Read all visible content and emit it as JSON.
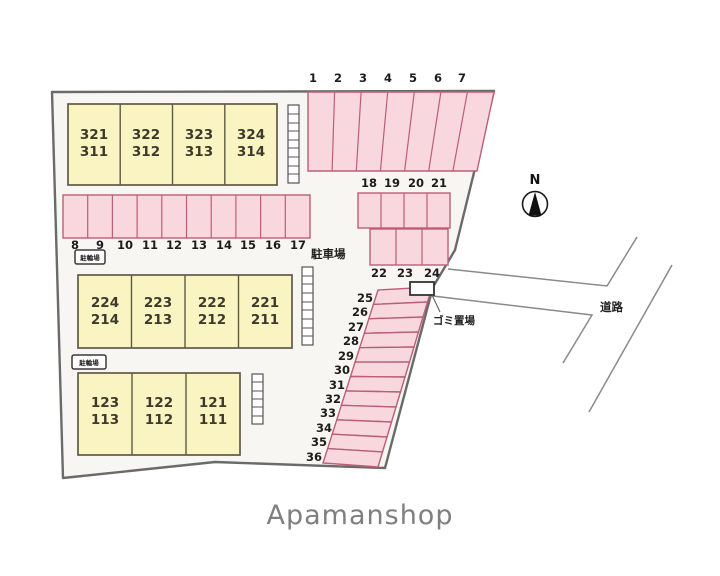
{
  "page": {
    "caption": "Apamanshop"
  },
  "compass": {
    "label": "N"
  },
  "labels": {
    "parking_lot": "駐車場",
    "garbage_area": "ゴミ置場",
    "road": "道路",
    "bicycle_area": "駐輪場"
  },
  "colors": {
    "stall_fill": "#f8d7de",
    "stall_border": "#bb5f78",
    "building_fill": "#faf4c3",
    "building_border": "#5f5a45",
    "site_boundary": "#6a6a6a",
    "road_line": "#8a8a8a",
    "caption_text": "#7f7f7f"
  },
  "buildings": {
    "top": {
      "cells": [
        {
          "l1": "321",
          "l2": "311"
        },
        {
          "l1": "322",
          "l2": "312"
        },
        {
          "l1": "323",
          "l2": "313"
        },
        {
          "l1": "324",
          "l2": "314"
        }
      ]
    },
    "middle": {
      "cells": [
        {
          "l1": "224",
          "l2": "214"
        },
        {
          "l1": "223",
          "l2": "213"
        },
        {
          "l1": "222",
          "l2": "212"
        },
        {
          "l1": "221",
          "l2": "211"
        }
      ]
    },
    "bottom": {
      "cells": [
        {
          "l1": "123",
          "l2": "113"
        },
        {
          "l1": "122",
          "l2": "112"
        },
        {
          "l1": "121",
          "l2": "111"
        }
      ]
    }
  },
  "stalls": {
    "row_1_7": [
      "1",
      "2",
      "3",
      "4",
      "5",
      "6",
      "7"
    ],
    "row_8_17": [
      "8",
      "9",
      "10",
      "11",
      "12",
      "13",
      "14",
      "15",
      "16",
      "17"
    ],
    "row_18_21": [
      "18",
      "19",
      "20",
      "21"
    ],
    "row_22_24": [
      "22",
      "23",
      "24"
    ],
    "strip_25_36": [
      "25",
      "26",
      "27",
      "28",
      "29",
      "30",
      "31",
      "32",
      "33",
      "34",
      "35",
      "36"
    ]
  }
}
